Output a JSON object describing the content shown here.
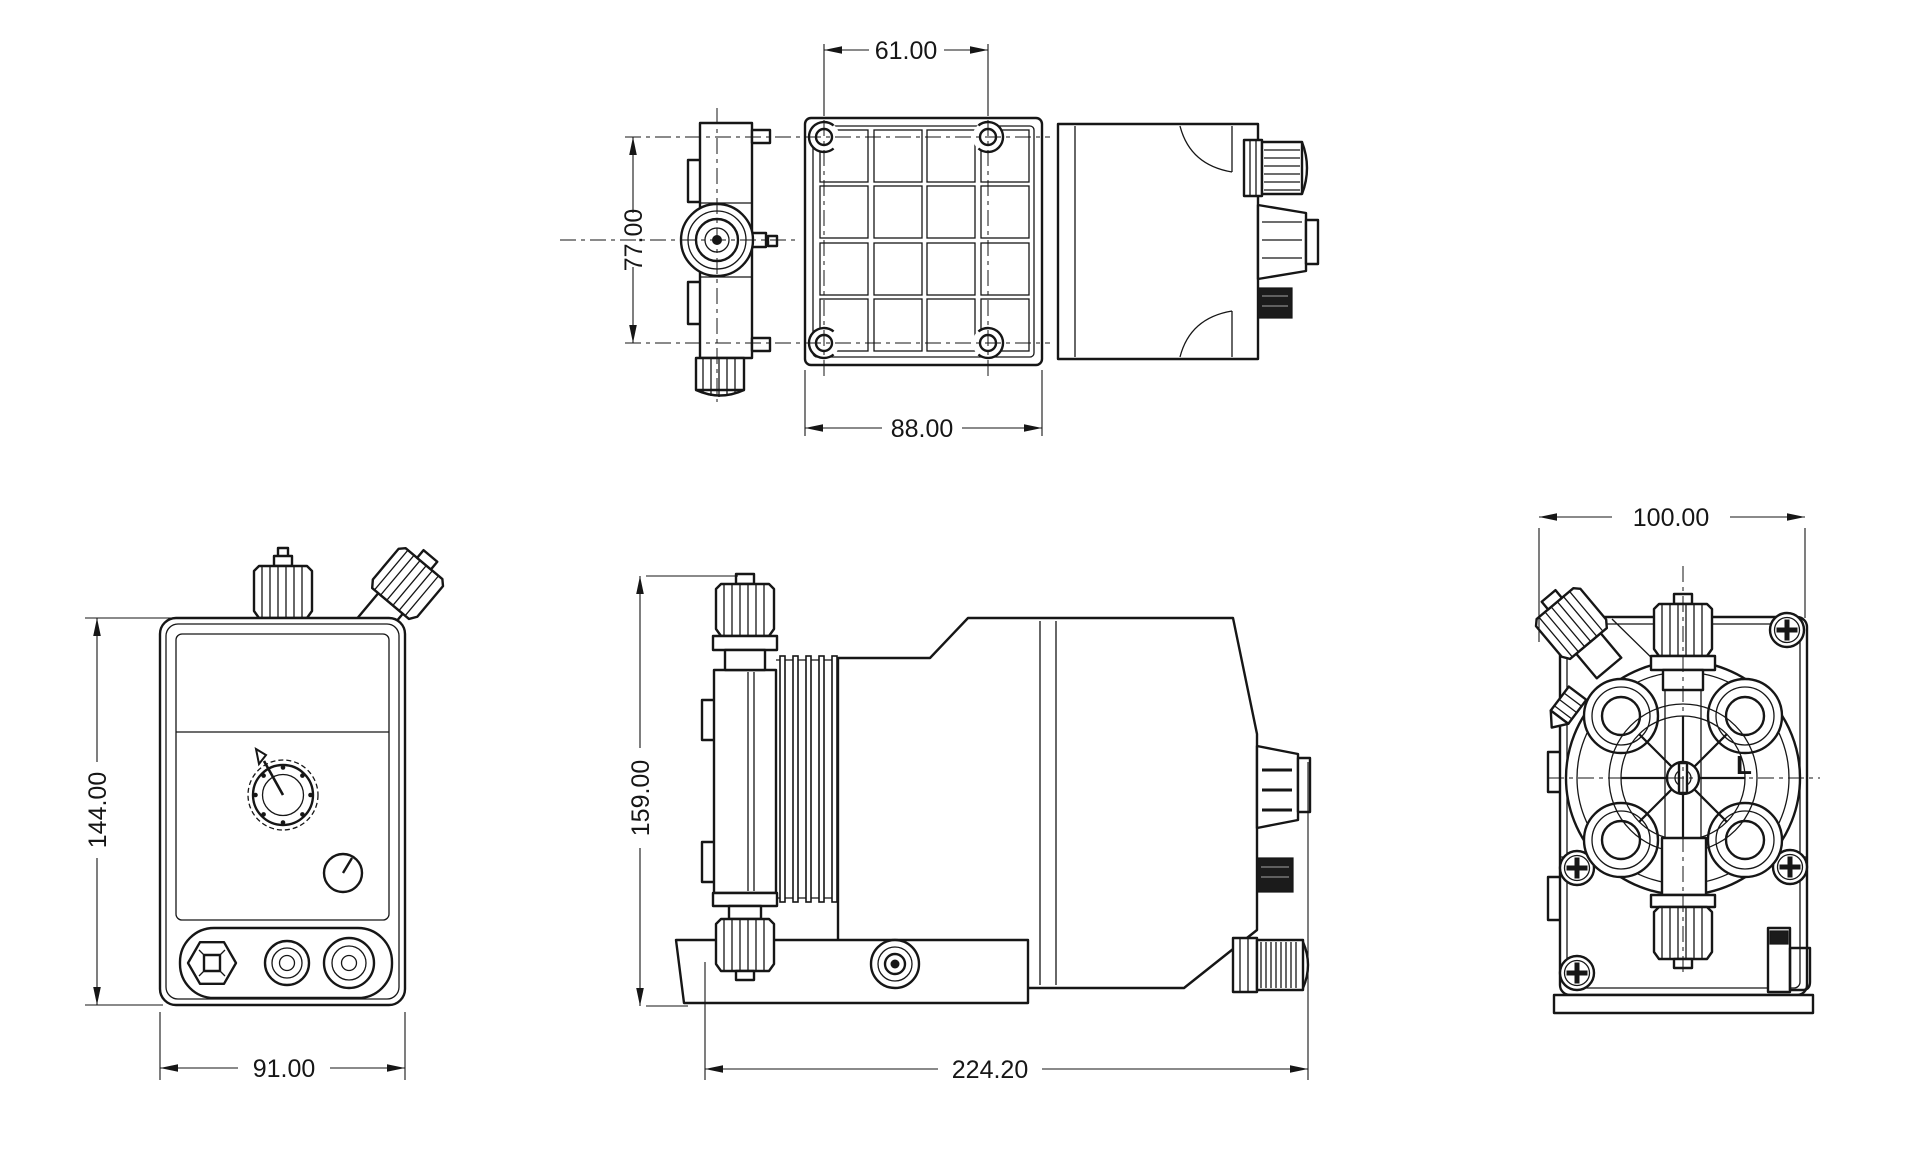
{
  "drawing": {
    "type": "technical-dimension-drawing",
    "subject": "dosing-pump-orthographic-views",
    "background_color": "#ffffff",
    "line_color": "#161616",
    "views": {
      "top": {
        "label": "top-view",
        "dims": {
          "bolt_spacing": "61.00",
          "bolt_row_spacing": "77.00",
          "base_width": "88.00"
        }
      },
      "front": {
        "label": "front-view",
        "dims": {
          "height": "144.00",
          "width": "91.00"
        }
      },
      "side": {
        "label": "side-view",
        "dims": {
          "height": "159.00",
          "length": "224.20"
        }
      },
      "rear": {
        "label": "rear-view",
        "dims": {
          "width": "100.00"
        },
        "marking": "L"
      }
    }
  }
}
